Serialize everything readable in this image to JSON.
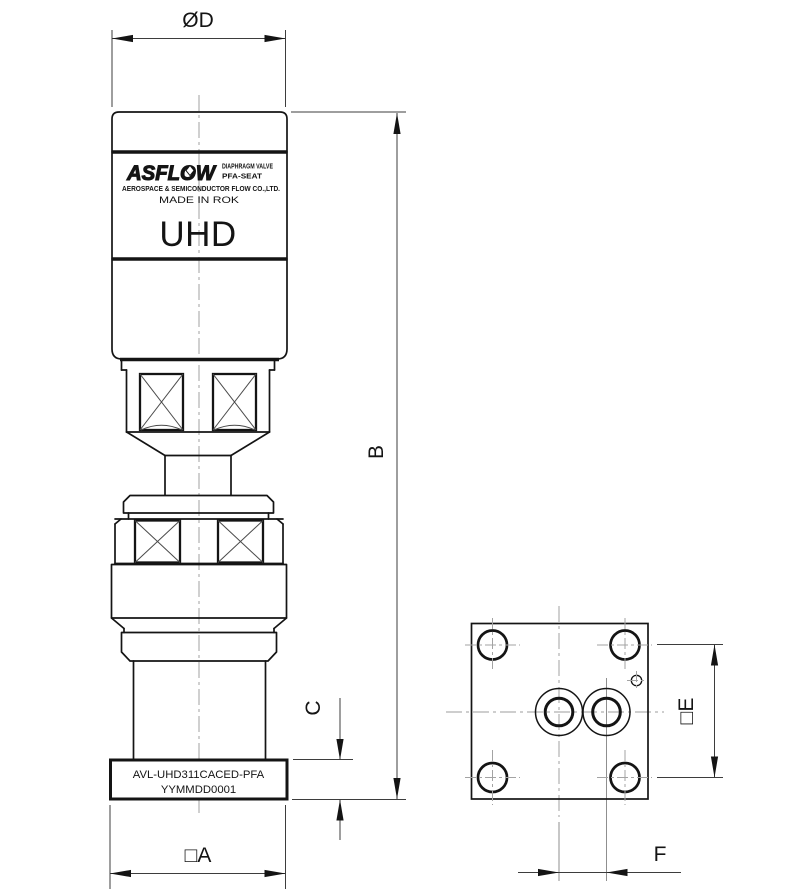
{
  "drawing": {
    "dimensions": {
      "top_diameter": "ØD",
      "overall_height": "B",
      "base_height": "C",
      "base_width": "□A",
      "bolt_square": "□E",
      "port_spacing": "F"
    },
    "nameplate": {
      "brand": "ASFLOW",
      "product_line": "DIAPHRAGM VALVE",
      "seat_line": "PFA-SEAT",
      "company_line": "AEROSPACE & SEMICONDUCTOR FLOW CO.,LTD.",
      "origin_line": "MADE IN ROK",
      "model": "UHD"
    },
    "base_label": {
      "part_number": "AVL-UHD311CACED-PFA",
      "lot_number": "YYMMDD0001"
    },
    "colors": {
      "line": "#141414",
      "dimension_line": "#3d3d3d",
      "centerline": "#b0b0b0",
      "background": "#ffffff"
    }
  }
}
